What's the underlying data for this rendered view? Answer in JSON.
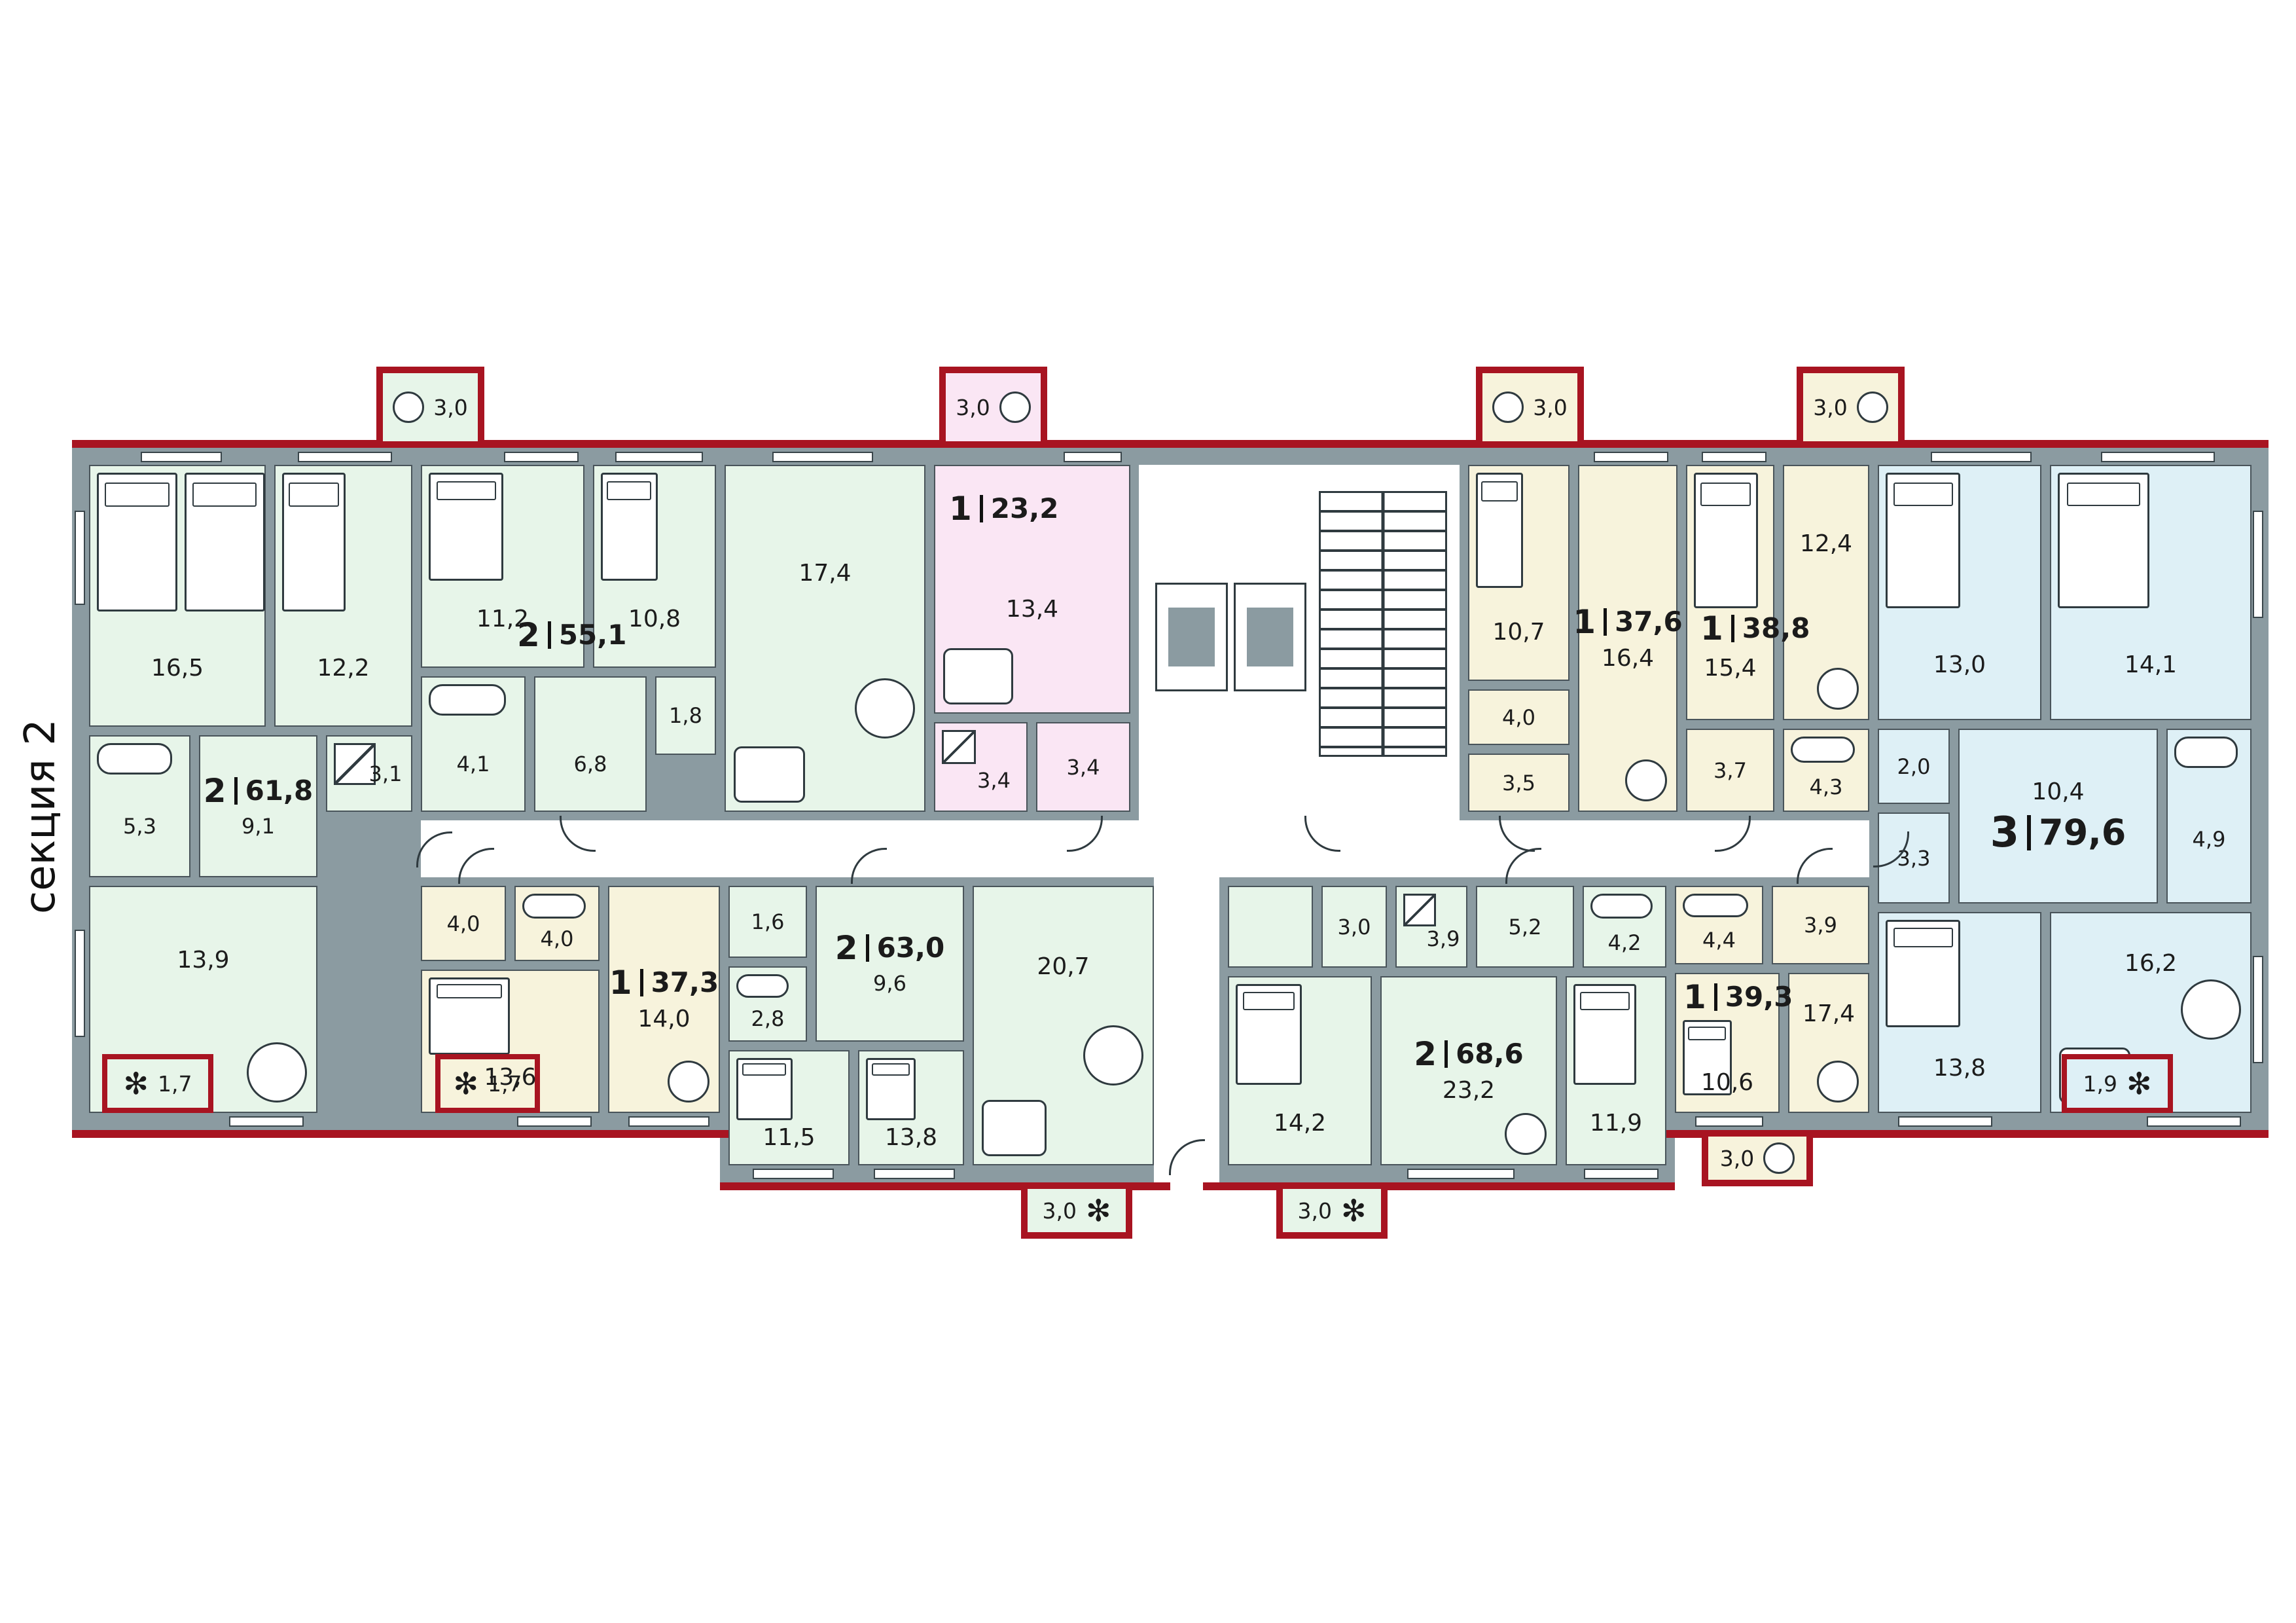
{
  "section_label": "секция 2",
  "colors": {
    "apartment_green": "#e7f5e9",
    "apartment_yellow": "#f7f3dc",
    "apartment_pink": "#fae6f4",
    "apartment_blue": "#def0f6",
    "wall_gray": "#8b9ba1",
    "exterior_red": "#a81421"
  },
  "apartments": {
    "a61_8": {
      "rooms_count": "2",
      "total_area": "61,8",
      "balcony": "1,7",
      "rooms": {
        "bedroom_1": "16,5",
        "bedroom_2": "12,2",
        "shower": "3,1",
        "bathroom": "5,3",
        "hall": "9,1",
        "kitchen_living": "13,9"
      }
    },
    "a55_1": {
      "rooms_count": "2",
      "total_area": "55,1",
      "balcony": "3,0",
      "rooms": {
        "bedroom_1": "11,2",
        "bedroom_2": "10,8",
        "living_kitchen": "17,4",
        "bathroom": "4,1",
        "hall": "6,8",
        "storage": "1,8"
      }
    },
    "a23_2": {
      "rooms_count": "1",
      "total_area": "23,2",
      "balcony": "3,0",
      "rooms": {
        "living_kitchen": "13,4",
        "bathroom": "3,4",
        "hall": "3,4"
      }
    },
    "a37_6": {
      "rooms_count": "1",
      "total_area": "37,6",
      "balcony": "3,0",
      "rooms": {
        "bedroom": "10,7",
        "living_kitchen": "16,4",
        "bathroom": "4,0",
        "hall": "3,5"
      }
    },
    "a38_8": {
      "rooms_count": "1",
      "total_area": "38,8",
      "balcony": "3,0",
      "rooms": {
        "bedroom": "15,4",
        "living_kitchen": "12,4",
        "hall": "3,7",
        "bathroom": "4,3"
      }
    },
    "a79_6": {
      "rooms_count": "3",
      "total_area": "79,6",
      "balcony": "1,9",
      "rooms": {
        "bedroom_1": "13,0",
        "bedroom_2": "14,1",
        "wardrobe": "2,0",
        "wc": "3,3",
        "hall": "10,4",
        "bathroom": "4,9",
        "bedroom_3": "13,8",
        "kitchen_living": "16,2"
      }
    },
    "a37_3": {
      "rooms_count": "1",
      "total_area": "37,3",
      "balcony": "1,7",
      "rooms": {
        "hall": "4,0",
        "bathroom": "4,0",
        "bedroom": "13,6",
        "kitchen_living": "14,0"
      }
    },
    "a63_0": {
      "rooms_count": "2",
      "total_area": "63,0",
      "balcony": "3,0",
      "rooms": {
        "wc": "1,6",
        "bathroom": "2,8",
        "hall": "9,6",
        "bedroom_1": "11,5",
        "bedroom_2": "13,8",
        "living_kitchen": "20,7"
      }
    },
    "a68_6": {
      "rooms_count": "2",
      "total_area": "68,6",
      "balcony": "3,0",
      "rooms": {
        "wardrobe": "3,0",
        "shower": "3,9",
        "hall": "5,2",
        "bathroom": "4,2",
        "bedroom_1": "14,2",
        "living_kitchen": "23,2",
        "bedroom_2": "11,9"
      }
    },
    "a39_3": {
      "rooms_count": "1",
      "total_area": "39,3",
      "balcony": "3,0",
      "rooms": {
        "bathroom": "4,4",
        "hall": "3,9",
        "bedroom": "10,6",
        "living_kitchen": "17,4"
      }
    }
  }
}
